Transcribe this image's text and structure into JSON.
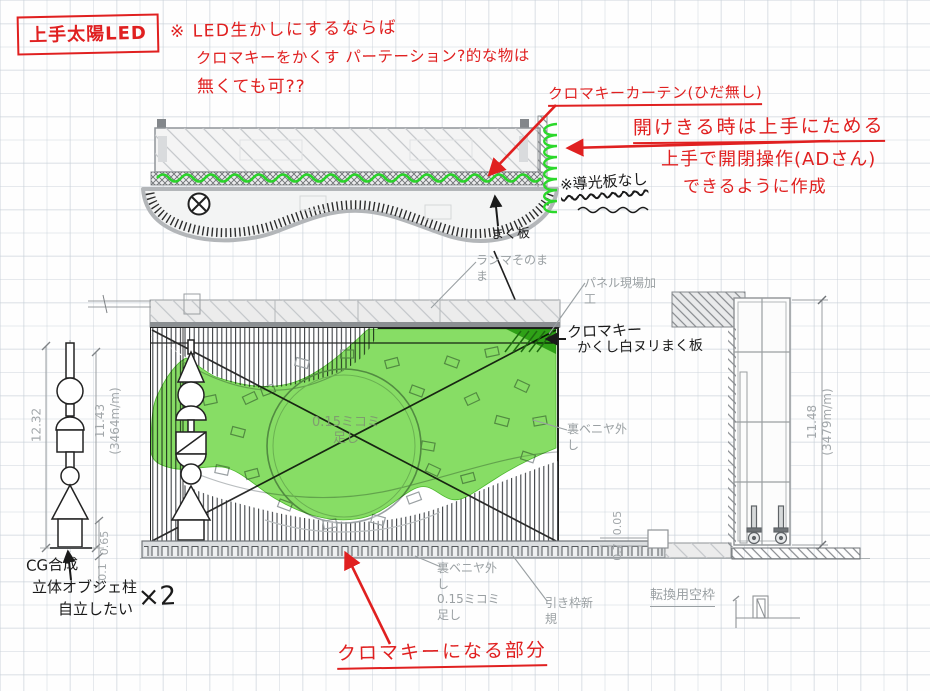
{
  "colors": {
    "annotation_red": "#e02020",
    "chroma_green": "#6fd544",
    "cad_gray": "#9aa0a3"
  },
  "red_notes": {
    "title_box": "上手太陽LED",
    "led_line1": "※ LED生かしにするならば",
    "led_line2": "クロマキーをかくす パーテーション?的な物は",
    "led_line3": "無くても可??",
    "curtain": "クロマキーカーテン(ひだ無し)",
    "gather": "開けきる時は上手にためる",
    "operate1": "上手で開閉操作(ADさん)",
    "operate2": "できるように作成",
    "chroma_part": "クロマキーになる部分"
  },
  "black_notes": {
    "no_light_guide": "※導光板なし",
    "maku_board": "まく板",
    "hide1": "クロマキー",
    "hide2": "かくし白ヌリまく板",
    "cg1": "CG合成",
    "cg2": "立体オブジェ柱",
    "cg3": "自立したい",
    "cg_qty": "×2"
  },
  "cad_labels": {
    "ranma": "ランマそのま\nま",
    "panel_site": "パネル現場加\n工",
    "veneer_right": "裏ベニヤ外\nし",
    "veneer_bottom": "裏ベニヤ外\nし\n0.15ミコミ\n足し",
    "pull_frame": "引き枠新\n規",
    "spare_frame": "転換用空枠",
    "center_add": "0.15ミコミ\n足し"
  },
  "dimensions": {
    "outer_height": "12.32",
    "inner_height": "11.43",
    "inner_height_mm": "(3464m/m)",
    "base_h1": "0.65",
    "base_h2": "0.1",
    "floor_d1": "0.05",
    "floor_d2": "0.7",
    "right_height": "11.48",
    "right_height_mm": "(3479m/m)"
  }
}
